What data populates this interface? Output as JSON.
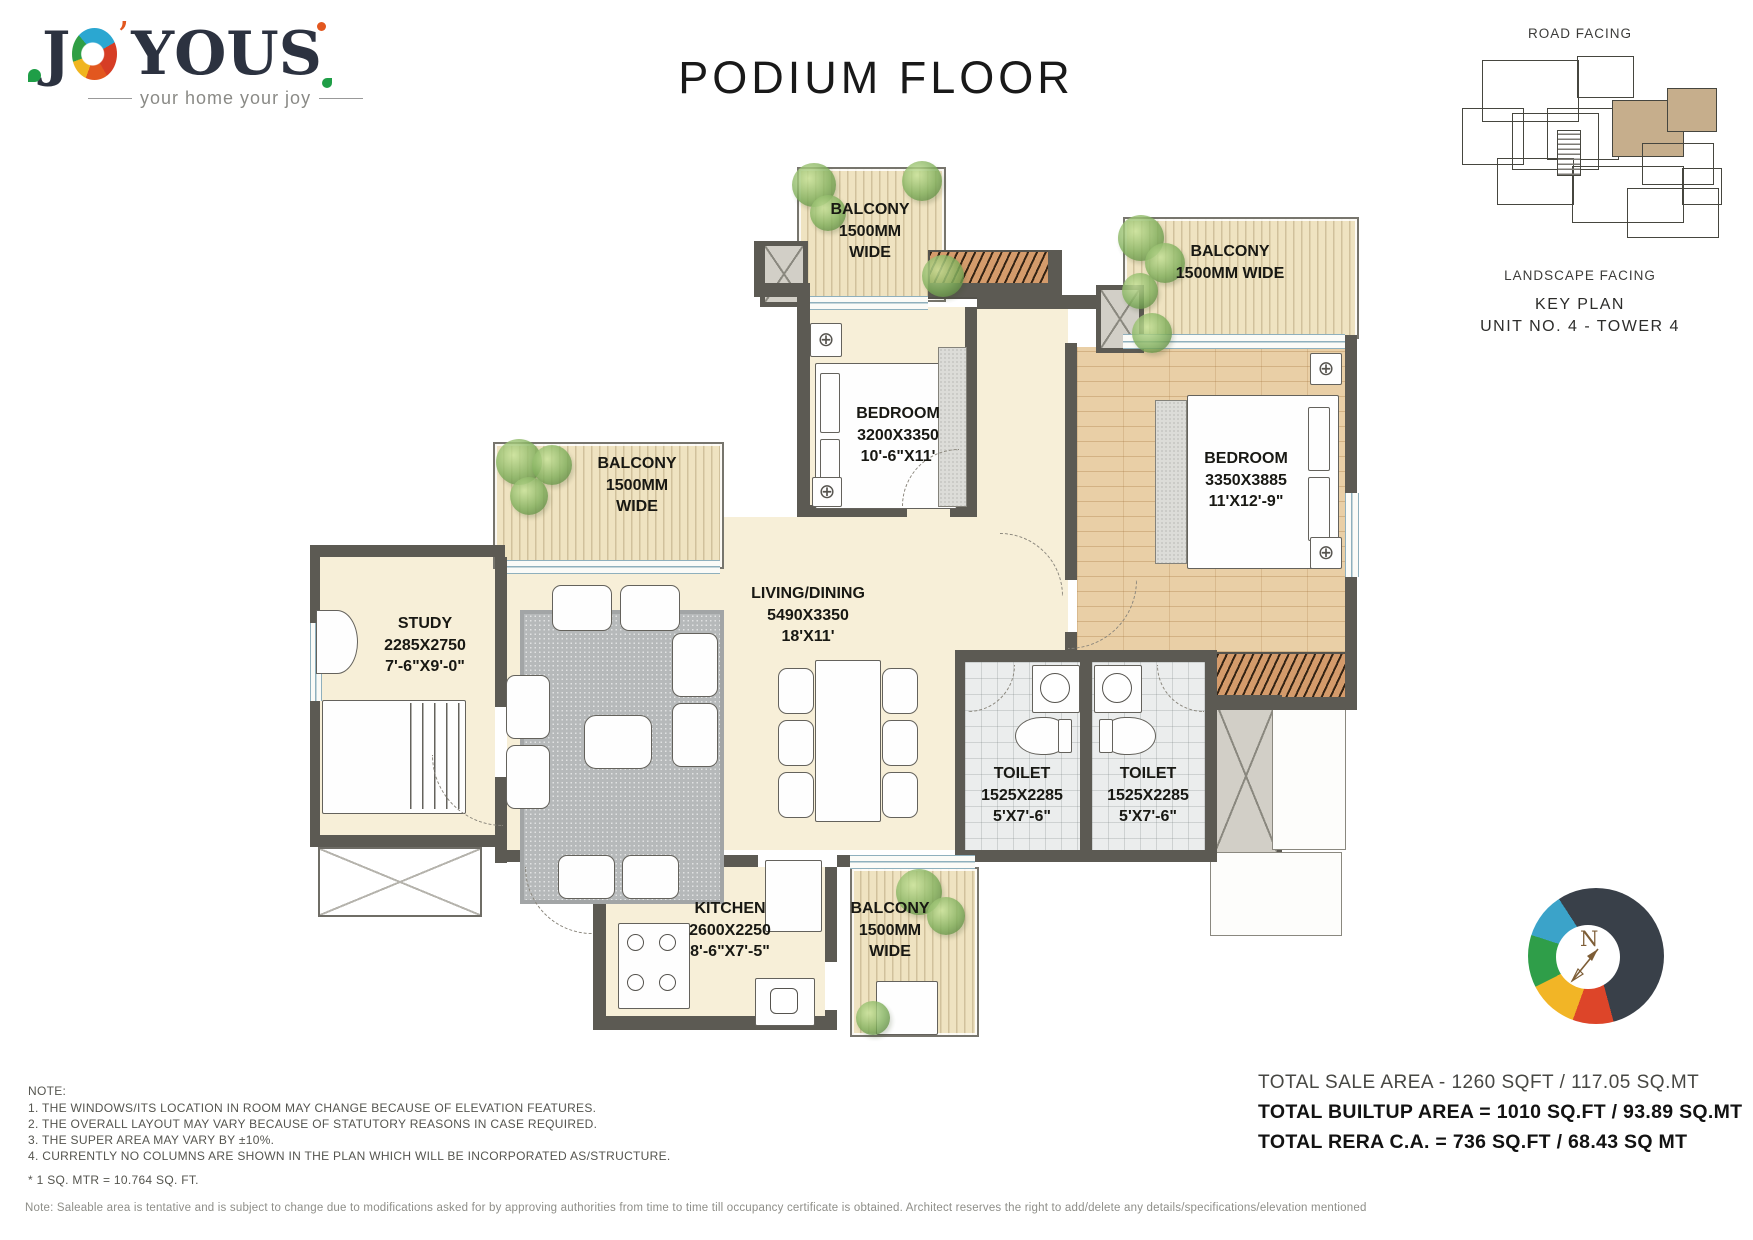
{
  "page": {
    "title": "PODIUM FLOOR"
  },
  "logo": {
    "word_start": "J",
    "word_y": "Y",
    "word_o": "O",
    "word_u": "U",
    "word_s": "S",
    "apostrophe": "’",
    "tagline": "your home your joy"
  },
  "key_plan": {
    "road": "ROAD FACING",
    "landscape": "LANDSCAPE FACING",
    "title": "KEY PLAN",
    "unit": "UNIT NO. 4 - TOWER 4"
  },
  "compass": {
    "north": "N"
  },
  "rooms": {
    "balcony_top": {
      "l1": "BALCONY",
      "l2": "1500MM",
      "l3": "WIDE"
    },
    "balcony_right": {
      "l1": "BALCONY",
      "l2": "1500MM WIDE"
    },
    "balcony_left": {
      "l1": "BALCONY",
      "l2": "1500MM",
      "l3": "WIDE"
    },
    "balcony_bottom": {
      "l1": "BALCONY",
      "l2": "1500MM",
      "l3": "WIDE"
    },
    "bedroom1": {
      "l1": "BEDROOM",
      "l2": "3200X3350",
      "l3": "10'-6\"X11'"
    },
    "bedroom2": {
      "l1": "BEDROOM",
      "l2": "3350X3885",
      "l3": "11'X12'-9\""
    },
    "study": {
      "l1": "STUDY",
      "l2": "2285X2750",
      "l3": "7'-6\"X9'-0\""
    },
    "living": {
      "l1": "LIVING/DINING",
      "l2": "5490X3350",
      "l3": "18'X11'"
    },
    "toilet1": {
      "l1": "TOILET",
      "l2": "1525X2285",
      "l3": "5'X7'-6\""
    },
    "toilet2": {
      "l1": "TOILET",
      "l2": "1525X2285",
      "l3": "5'X7'-6\""
    },
    "kitchen": {
      "l1": "KITCHEN",
      "l2": "2600X2250",
      "l3": "8'-6\"X7'-5\""
    }
  },
  "notes": {
    "heading": "NOTE:",
    "items": [
      "1. THE WINDOWS/ITS LOCATION IN ROOM MAY CHANGE BECAUSE OF ELEVATION FEATURES.",
      "2. THE OVERALL LAYOUT MAY VARY BECAUSE OF STATUTORY REASONS IN CASE REQUIRED.",
      "3. THE SUPER AREA MAY VARY BY ±10%.",
      "4. CURRENTLY NO COLUMNS ARE SHOWN IN THE PLAN WHICH WILL BE INCORPORATED AS/STRUCTURE."
    ],
    "conversion": "* 1 SQ. MTR = 10.764 SQ. FT."
  },
  "areas": {
    "sale": "TOTAL SALE AREA - 1260 SQFT / 117.05 SQ.MT",
    "builtup": "TOTAL BUILTUP AREA = 1010 SQ.FT / 93.89 SQ.MT",
    "rera": "TOTAL RERA C.A. = 736 SQ.FT / 68.43 SQ MT"
  },
  "disclaimer": "Note: Saleable area is tentative and is subject to change due to modifications asked for by approving authorities from time to time till occupancy certificate is obtained. Architect reserves the right to add/delete any details/specifications/elevation mentioned",
  "colors": {
    "wall": "#5c5a53",
    "unit_highlight": "#c6ae8c",
    "balcony_floor": "#efe3c1",
    "wood_floor": "#e9cfa6"
  }
}
